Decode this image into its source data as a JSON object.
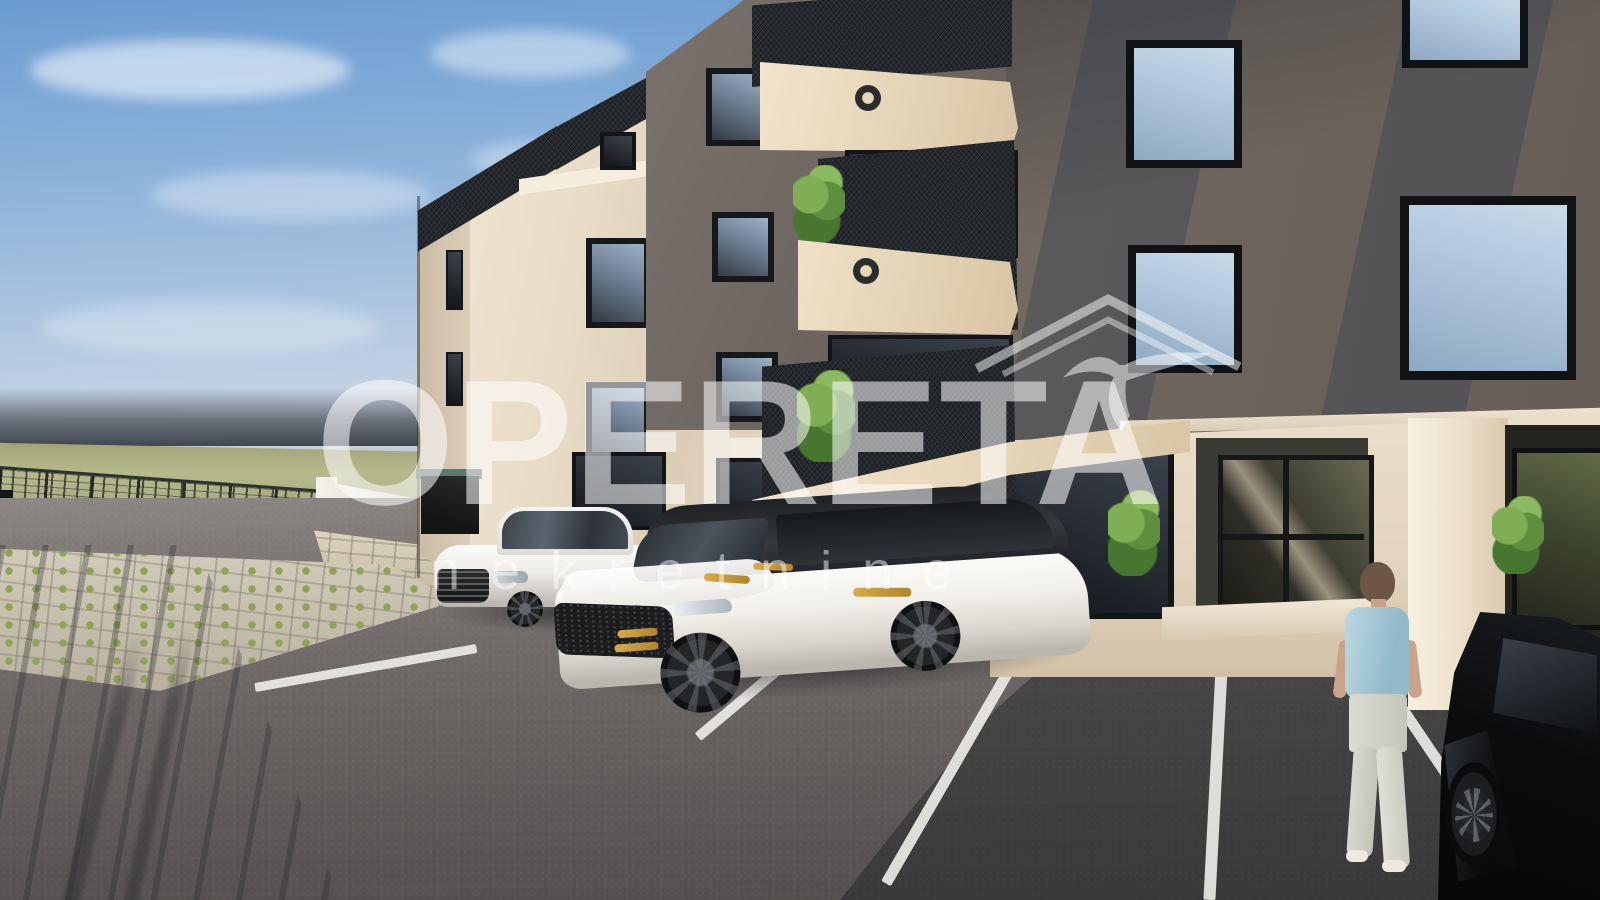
{
  "watermark": {
    "title": "OPERETA",
    "subtitle": "nekretnine",
    "logo": "house-with-swallow-outline",
    "text_color": "#ffffff",
    "opacity": 0.52
  },
  "scene": {
    "type": "3d-architectural-exterior-render",
    "subject": "modern four-storey apartment building with parking lot",
    "building": {
      "facade_cream": "#e9decb",
      "facade_dark_plaster": "#6b635b",
      "balcony_mesh": "#24282d",
      "window_frame": "#141619",
      "features": [
        "black mesh balcony railings",
        "beige balcony slabs with round ceiling lights",
        "sky-reflecting square windows",
        "glass entrance door",
        "green potted plants"
      ]
    },
    "vehicles": [
      {
        "name": "white-sedan"
      },
      {
        "name": "white-suv-black-roof",
        "accent_color": "#c79a3e"
      },
      {
        "name": "black-coupe"
      }
    ],
    "people": [
      {
        "name": "woman-walking-to-entrance",
        "shirt_color": "#a8cdd9",
        "pants_color": "#d9d9d2"
      }
    ],
    "ground": {
      "asphalt": "#6b6664",
      "parking_line": "#eceae6",
      "grass_pavers": "#c9c3b3",
      "field": "#b4b68a",
      "fence": "#2c322e"
    },
    "sky": {
      "top": "#6b9cd1",
      "horizon": "#c3ccd3",
      "haze_band": "#4a5059"
    }
  }
}
